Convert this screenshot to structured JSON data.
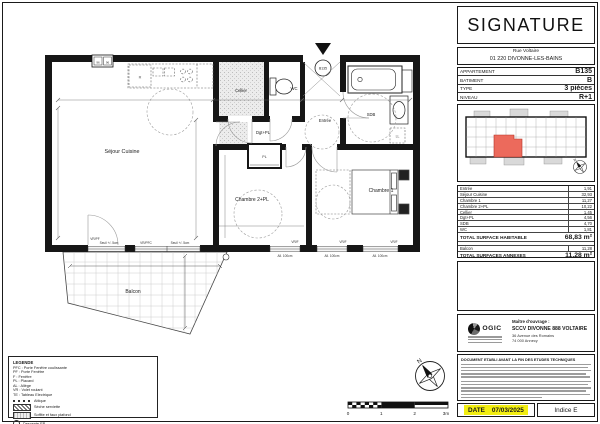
{
  "plan": {
    "rooms": {
      "sejour": "Séjour Cuisine",
      "cellier": "Cellier",
      "wc": "WC",
      "entree": "Entrée",
      "sdb": "SDB",
      "dgt": "Dgt+PL",
      "placard": "PL",
      "chambre2": "Chambre 2+PL",
      "chambre1": "Chambre 1",
      "balcon": "Balcon"
    },
    "entry_unit": "B135",
    "fridge": "R",
    "washer": "LL",
    "vent_left": "96",
    "vent_right": "96",
    "windows": {
      "w1": "VR/PF",
      "w1n": "Seuil +/- 5cm",
      "w2": "VR/PFC",
      "w2n": "Seuil +/- 5cm",
      "w3": "VR/F",
      "w3n": "All. 100cm",
      "w4": "VR/F",
      "w4n": "All. 100cm",
      "w5": "VR/F",
      "w5n": "All. 100cm"
    },
    "scale": [
      "0",
      "1",
      "2",
      "3m"
    ],
    "north": "N"
  },
  "legend": {
    "title": "LEGENDE",
    "lines": [
      "PFC : Porte Fenêtre coulissante",
      "PF : Porte Fenêtre",
      "F : Fenêtre",
      "PL : Placard",
      "AL : Allège",
      "VR : Volet roulant",
      "TE : Tableau Electrique"
    ],
    "symbols": [
      "Attique",
      "Sèche serviette",
      "Soffite et faux plafond",
      "Descente EP"
    ]
  },
  "panel": {
    "logo": "SIGNATURE",
    "address1": "Rue Voltaire",
    "address2": "01 220 DIVONNE-LES-BAINS",
    "info": [
      {
        "label": "APPARTEMENT",
        "value": "B135"
      },
      {
        "label": "BATIMENT",
        "value": "B"
      },
      {
        "label": "TYPE",
        "value": "3 pièces"
      },
      {
        "label": "NIVEAU",
        "value": "R+1"
      }
    ],
    "surfaces": {
      "rows": [
        {
          "label": "Entrée",
          "value": "1,91"
        },
        {
          "label": "Séjour Cuisine",
          "value": "32,93"
        },
        {
          "label": "Chambre 1",
          "value": "11,27"
        },
        {
          "label": "Chambre 2+PL",
          "value": "10,22"
        },
        {
          "label": "Cellier",
          "value": "1,45"
        },
        {
          "label": "Dgt+PL",
          "value": "4,56"
        },
        {
          "label": "SDB",
          "value": "4,70"
        },
        {
          "label": "WC",
          "value": "1,81"
        }
      ],
      "total_label": "TOTAL SURFACE HABITABLE",
      "total_value": "68,83 m²",
      "annex_rows": [
        {
          "label": "Balcon",
          "value": "11,28"
        }
      ],
      "annex_total_label": "TOTAL SURFACES ANNEXES",
      "annex_total_value": "11,28 m²"
    },
    "owner": {
      "logo": "OGIC",
      "heading": "Maître d'ouvrage :",
      "name": "SCCV DIVONNE 888 VOLTAIRE",
      "line1": "36 Avenue des Romains",
      "line2": "74 000 Annecy"
    },
    "fineprint_title": "DOCUMENT ETABLI AVANT LA FIN DES ETUDES TECHNIQUES",
    "date_label": "DATE",
    "date_value": "07/03/2025",
    "indice": "Indice E"
  }
}
